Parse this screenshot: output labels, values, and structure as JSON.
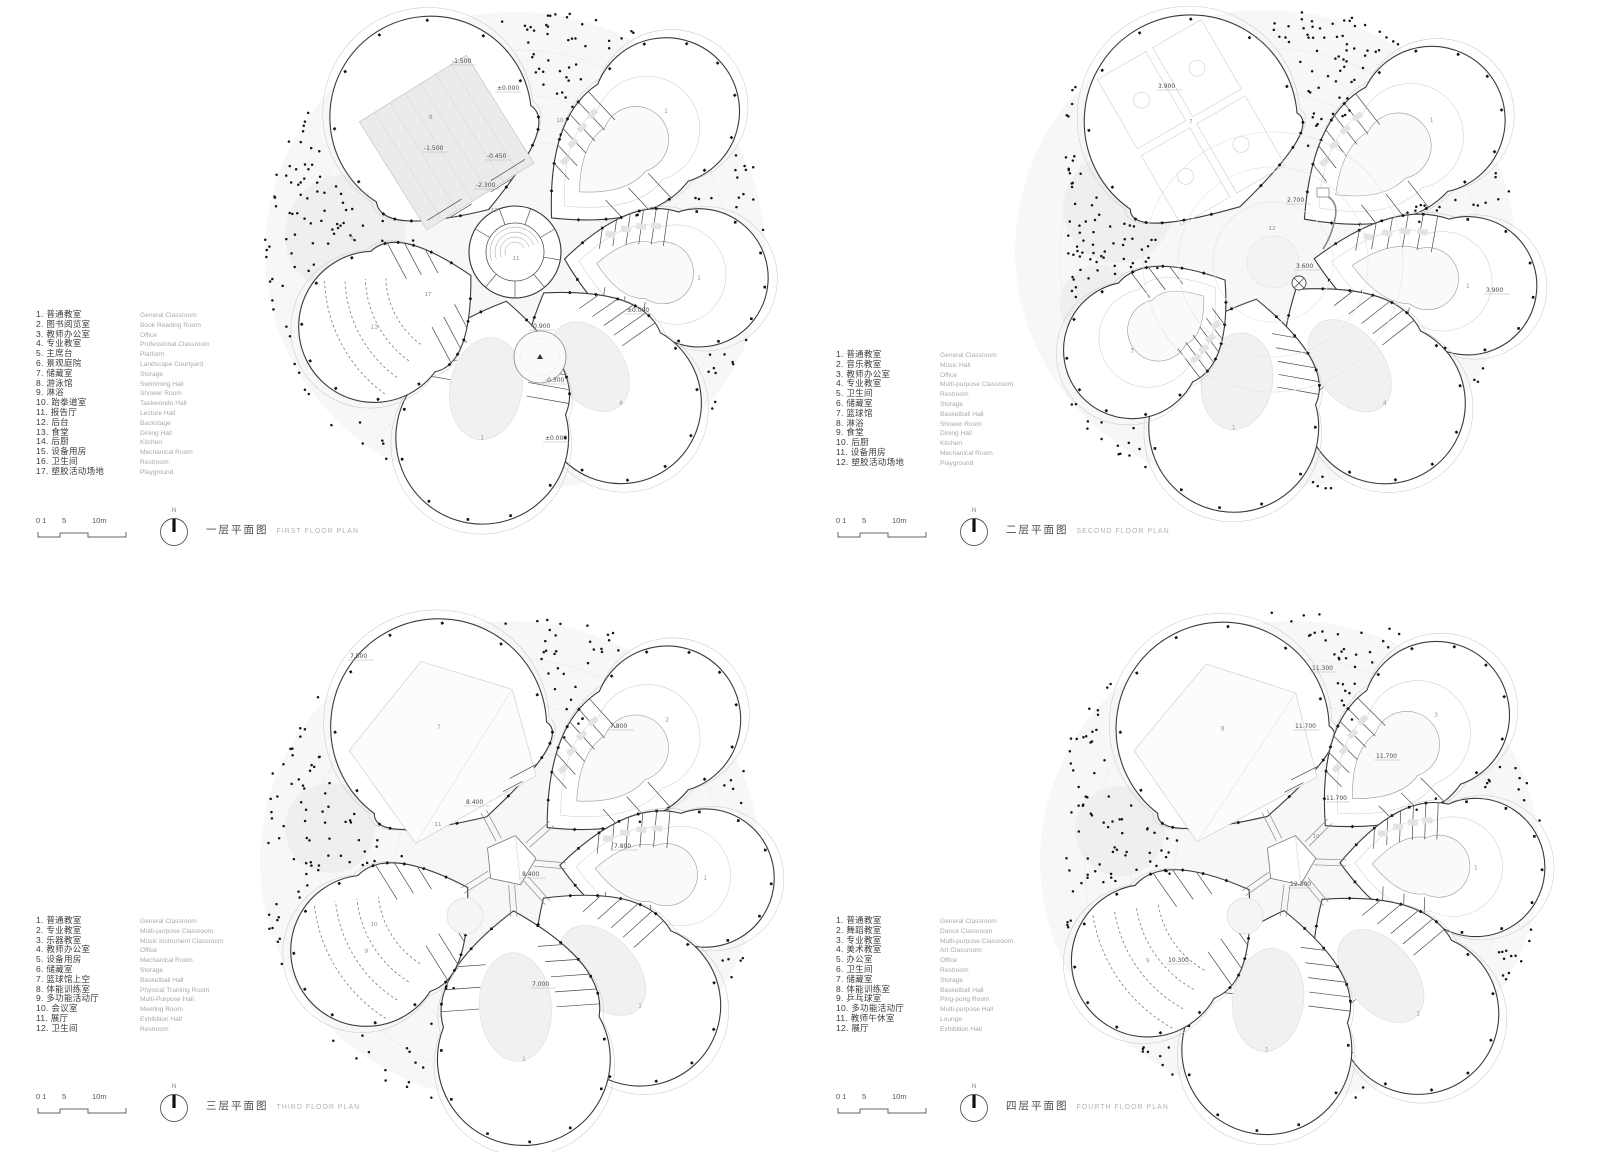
{
  "panels": [
    {
      "title_zh": "一层平面图",
      "title_en": "FIRST FLOOR PLAN",
      "north": "N",
      "scale": [
        "0 1",
        "5",
        "10m"
      ],
      "legend": {
        "items": [
          {
            "zh": "1. 普通教室",
            "en": "General Classroom"
          },
          {
            "zh": "2. 图书阅览室",
            "en": "Book Reading Room"
          },
          {
            "zh": "3. 教师办公室",
            "en": "Office"
          },
          {
            "zh": "4. 专业教室",
            "en": "Professional Classroom"
          },
          {
            "zh": "5. 主席台",
            "en": "Platform"
          },
          {
            "zh": "6. 景观庭院",
            "en": "Landscape Courtyard"
          },
          {
            "zh": "7. 储藏室",
            "en": "Storage"
          },
          {
            "zh": "8. 游泳馆",
            "en": "Swimming Hall"
          },
          {
            "zh": "9. 淋浴",
            "en": "Shower Room"
          },
          {
            "zh": "10. 跆拳道室",
            "en": "Taekwondo Hall"
          },
          {
            "zh": "11. 报告厅",
            "en": "Lecture Hall"
          },
          {
            "zh": "12. 后台",
            "en": "Backstage"
          },
          {
            "zh": "13. 食堂",
            "en": "Dining Hall"
          },
          {
            "zh": "14. 后厨",
            "en": "Kitchen"
          },
          {
            "zh": "15. 设备用房",
            "en": "Mechanical Room"
          },
          {
            "zh": "16. 卫生间",
            "en": "Restroom"
          },
          {
            "zh": "17. 塑胶活动场地",
            "en": "Playground"
          }
        ]
      },
      "plan": {
        "seed": 7,
        "cx": 515,
        "cy": 252,
        "dots": 150,
        "center": "ring",
        "wings": [
          {
            "a": -122,
            "len": 210,
            "w": 140,
            "f": "pool",
            "num": "8"
          },
          {
            "a": -43,
            "len": 230,
            "w": 102,
            "f": "rooms",
            "num": "1"
          },
          {
            "a": 8,
            "len": 205,
            "w": 96,
            "f": "rooms",
            "num": "1"
          },
          {
            "a": 55,
            "len": 215,
            "w": 112,
            "f": "court",
            "num": "4"
          },
          {
            "a": 100,
            "len": 225,
            "w": 120,
            "f": "court",
            "num": "1"
          },
          {
            "a": 152,
            "len": 185,
            "w": 105,
            "f": "fan",
            "num": "13"
          }
        ],
        "ghosts": [
          {
            "x": 345,
            "y": 235,
            "r": 60
          },
          {
            "x": 612,
            "y": 182,
            "r": 42
          }
        ],
        "labels": [
          {
            "t": "-1.500",
            "x": 452,
            "y": 63
          },
          {
            "t": "±0.000",
            "x": 497,
            "y": 90
          },
          {
            "t": "-1.500",
            "x": 424,
            "y": 150
          },
          {
            "t": "-0.450",
            "x": 487,
            "y": 158
          },
          {
            "t": "-2.300",
            "x": 476,
            "y": 187
          },
          {
            "t": "±0.000",
            "x": 627,
            "y": 312
          },
          {
            "t": "-0.900",
            "x": 531,
            "y": 328
          },
          {
            "t": "-0.300",
            "x": 545,
            "y": 382
          },
          {
            "t": "±0.000",
            "x": 545,
            "y": 440
          }
        ],
        "room_labels": [
          {
            "t": "11",
            "x": 516,
            "y": 260
          },
          {
            "t": "12",
            "x": 494,
            "y": 212
          },
          {
            "t": "17",
            "x": 428,
            "y": 296
          },
          {
            "t": "10",
            "x": 560,
            "y": 122
          },
          {
            "t": "5",
            "x": 352,
            "y": 240
          }
        ]
      }
    },
    {
      "title_zh": "二层平面图",
      "title_en": "SECOND FLOOR PLAN",
      "north": "N",
      "scale": [
        "0 1",
        "5",
        "10m"
      ],
      "legend": {
        "items": [
          {
            "zh": "1. 普通教室",
            "en": "General Classroom"
          },
          {
            "zh": "2. 音乐教室",
            "en": "Music Hall"
          },
          {
            "zh": "3. 教师办公室",
            "en": "Office"
          },
          {
            "zh": "4. 专业教室",
            "en": "Multi-purpose Classroom"
          },
          {
            "zh": "5. 卫生间",
            "en": "Restroom"
          },
          {
            "zh": "6. 储藏室",
            "en": "Storage"
          },
          {
            "zh": "7. 篮球馆",
            "en": "Basketball Hall"
          },
          {
            "zh": "8. 淋浴",
            "en": "Shower Room"
          },
          {
            "zh": "9. 食堂",
            "en": "Dining Hall"
          },
          {
            "zh": "10. 后厨",
            "en": "Kitchen"
          },
          {
            "zh": "11. 设备用房",
            "en": "Mechanical Room"
          },
          {
            "zh": "12. 塑胶活动场地",
            "en": "Playground"
          }
        ]
      },
      "plan": {
        "seed": 11,
        "cx": 465,
        "cy": 250,
        "dots": 170,
        "center": "landscape",
        "wings": [
          {
            "a": -120,
            "len": 205,
            "w": 148,
            "f": "courts",
            "num": "7"
          },
          {
            "a": -38,
            "len": 235,
            "w": 102,
            "f": "rooms",
            "num": "1"
          },
          {
            "a": 10,
            "len": 225,
            "w": 96,
            "f": "rooms",
            "num": "1"
          },
          {
            "a": 52,
            "len": 225,
            "w": 112,
            "f": "court",
            "num": "4"
          },
          {
            "a": 100,
            "len": 215,
            "w": 118,
            "f": "court",
            "num": "1"
          },
          {
            "a": 143,
            "len": 185,
            "w": 95,
            "f": "rooms",
            "num": "3"
          }
        ],
        "ghosts": [
          {
            "x": 318,
            "y": 208,
            "r": 55
          },
          {
            "x": 300,
            "y": 305,
            "r": 40
          }
        ],
        "labels": [
          {
            "t": "3.900",
            "x": 358,
            "y": 88
          },
          {
            "t": "2.700",
            "x": 487,
            "y": 202
          },
          {
            "t": "3.600",
            "x": 496,
            "y": 268
          },
          {
            "t": "3.900",
            "x": 686,
            "y": 292
          }
        ],
        "room_labels": [
          {
            "t": "12",
            "x": 472,
            "y": 230
          }
        ]
      }
    },
    {
      "title_zh": "三层平面图",
      "title_en": "THIRD FLOOR PLAN",
      "north": "N",
      "scale": [
        "0 1",
        "5",
        "10m"
      ],
      "legend": {
        "items": [
          {
            "zh": "1. 普通教室",
            "en": "General Classroom"
          },
          {
            "zh": "2. 专业教室",
            "en": "Multi-purpose Classroom"
          },
          {
            "zh": "3. 乐器教室",
            "en": "Music Instrument Classroom"
          },
          {
            "zh": "4. 教师办公室",
            "en": "Office"
          },
          {
            "zh": "5. 设备用房",
            "en": "Mechanical Room"
          },
          {
            "zh": "6. 储藏室",
            "en": "Storage"
          },
          {
            "zh": "7. 篮球馆上空",
            "en": "Basketball Hall"
          },
          {
            "zh": "8. 体能训练室",
            "en": "Physical Training Room"
          },
          {
            "zh": "9. 多功能活动厅",
            "en": "Multi-Purpose Hall"
          },
          {
            "zh": "10. 会议室",
            "en": "Meeting Room"
          },
          {
            "zh": "11. 展厅",
            "en": "Exhibition Hall"
          },
          {
            "zh": "12. 卫生间",
            "en": "Restroom"
          }
        ]
      },
      "plan": {
        "seed": 23,
        "cx": 510,
        "cy": 285,
        "dots": 130,
        "center": "bridges",
        "wings": [
          {
            "a": -118,
            "len": 210,
            "w": 150,
            "f": "hall",
            "num": "7"
          },
          {
            "a": -42,
            "len": 235,
            "w": 102,
            "f": "rooms",
            "num": "2"
          },
          {
            "a": 5,
            "len": 215,
            "w": 96,
            "f": "rooms",
            "num": "1"
          },
          {
            "a": 48,
            "len": 225,
            "w": 112,
            "f": "court",
            "num": "1"
          },
          {
            "a": 86,
            "len": 235,
            "w": 120,
            "f": "court",
            "num": "1"
          },
          {
            "a": 148,
            "len": 195,
            "w": 105,
            "f": "fan",
            "num": "9"
          }
        ],
        "ghosts": [
          {
            "x": 330,
            "y": 252,
            "r": 45
          }
        ],
        "labels": [
          {
            "t": "7.500",
            "x": 350,
            "y": 82
          },
          {
            "t": "7.800",
            "x": 610,
            "y": 152
          },
          {
            "t": "8.400",
            "x": 466,
            "y": 228
          },
          {
            "t": "8.400",
            "x": 522,
            "y": 300
          },
          {
            "t": "7.800",
            "x": 614,
            "y": 272
          },
          {
            "t": "7.000",
            "x": 532,
            "y": 410
          }
        ],
        "room_labels": [
          {
            "t": "11",
            "x": 438,
            "y": 250
          },
          {
            "t": "10",
            "x": 374,
            "y": 350
          }
        ]
      }
    },
    {
      "title_zh": "四层平面图",
      "title_en": "FOURTH FLOOR PLAN",
      "north": "N",
      "scale": [
        "0 1",
        "5",
        "10m"
      ],
      "legend": {
        "items": [
          {
            "zh": "1. 普通教室",
            "en": "General Classroom"
          },
          {
            "zh": "2. 舞蹈教室",
            "en": "Dance Classroom"
          },
          {
            "zh": "3. 专业教室",
            "en": "Multi-purpose Classroom"
          },
          {
            "zh": "4. 美术教室",
            "en": "Art Classroom"
          },
          {
            "zh": "5. 办公室",
            "en": "Office"
          },
          {
            "zh": "6. 卫生间",
            "en": "Restroom"
          },
          {
            "zh": "7. 储藏室",
            "en": "Storage"
          },
          {
            "zh": "8. 体能训练室",
            "en": "Basketball Hall"
          },
          {
            "zh": "9. 乒乓球室",
            "en": "Ping-pong Room"
          },
          {
            "zh": "10. 多功能活动厅",
            "en": "Multi-purpose Hall"
          },
          {
            "zh": "11. 教师午休室",
            "en": "Lounge"
          },
          {
            "zh": "12. 展厅",
            "en": "Exhibition Hall"
          }
        ]
      },
      "plan": {
        "seed": 31,
        "cx": 490,
        "cy": 285,
        "dots": 140,
        "center": "bridges",
        "wings": [
          {
            "a": -117,
            "len": 205,
            "w": 148,
            "f": "hall",
            "num": "8"
          },
          {
            "a": -45,
            "len": 230,
            "w": 102,
            "f": "rooms",
            "num": "3"
          },
          {
            "a": 2,
            "len": 205,
            "w": 96,
            "f": "rooms",
            "num": "1"
          },
          {
            "a": 50,
            "len": 230,
            "w": 112,
            "f": "court",
            "num": "1"
          },
          {
            "a": 97,
            "len": 225,
            "w": 118,
            "f": "court",
            "num": "1"
          },
          {
            "a": 145,
            "len": 200,
            "w": 106,
            "f": "fan",
            "num": "9"
          }
        ],
        "ghosts": [
          {
            "x": 320,
            "y": 255,
            "r": 45
          }
        ],
        "labels": [
          {
            "t": "11.300",
            "x": 512,
            "y": 94
          },
          {
            "t": "11.700",
            "x": 495,
            "y": 152
          },
          {
            "t": "11.700",
            "x": 576,
            "y": 182
          },
          {
            "t": "11.700",
            "x": 526,
            "y": 224
          },
          {
            "t": "12.300",
            "x": 490,
            "y": 310
          },
          {
            "t": "10.300",
            "x": 368,
            "y": 386
          }
        ],
        "room_labels": [
          {
            "t": "10",
            "x": 516,
            "y": 262
          }
        ]
      }
    }
  ],
  "colors": {
    "wall": "#3a3a3a",
    "light_line": "#c9c9c9",
    "ground": "#f7f7f7",
    "ghost": "#efefef",
    "dot": "#141414",
    "label_text": "#4a4a4a"
  }
}
